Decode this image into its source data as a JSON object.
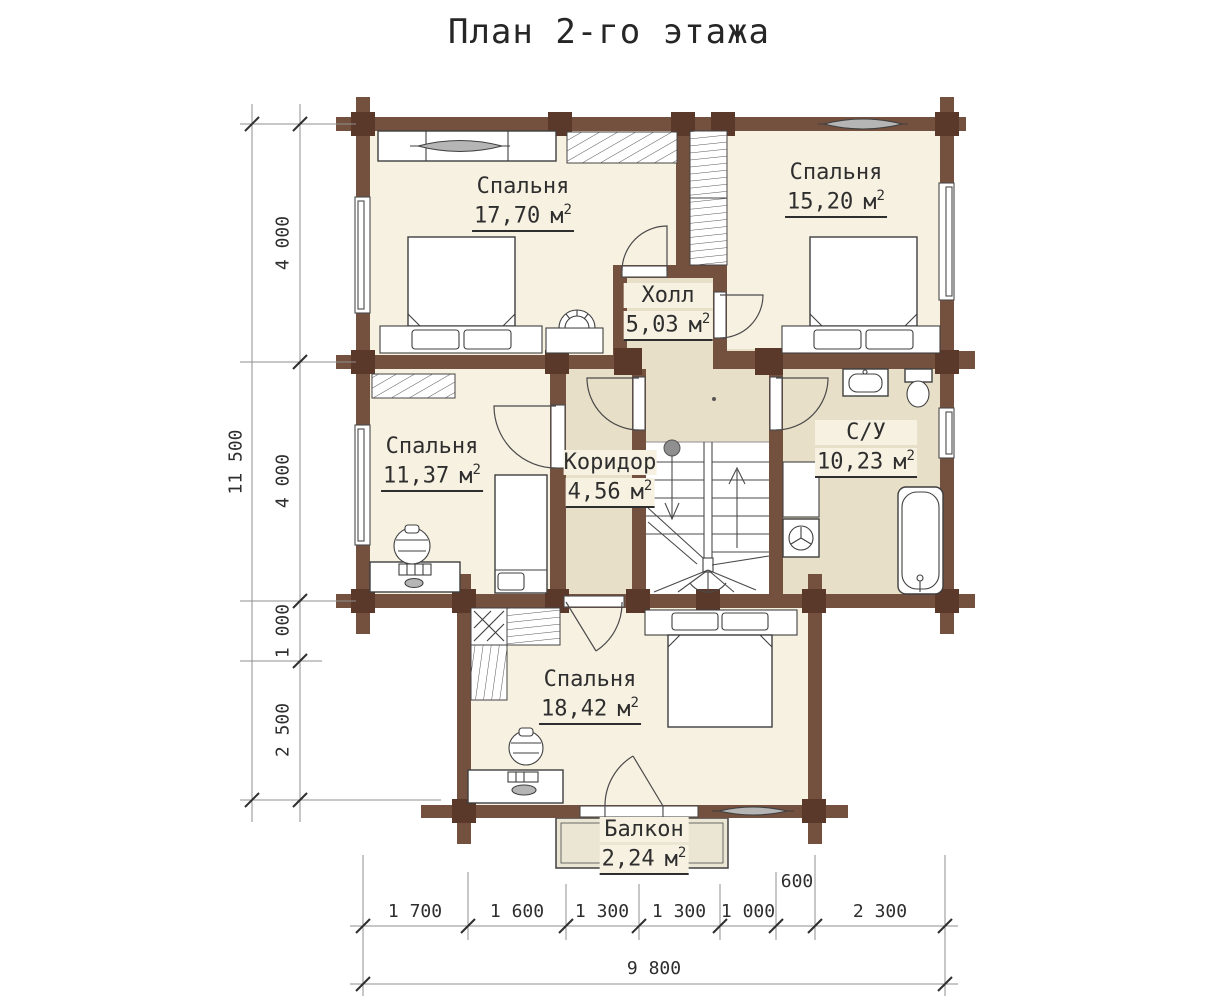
{
  "title": "План 2-го этажа",
  "rooms": [
    {
      "name": "Спальня",
      "area": "17,70",
      "unit": "м",
      "sup": "2"
    },
    {
      "name": "Спальня",
      "area": "15,20",
      "unit": "м",
      "sup": "2"
    },
    {
      "name": "Холл",
      "area": "5,03",
      "unit": "м",
      "sup": "2"
    },
    {
      "name": "Спальня",
      "area": "11,37",
      "unit": "м",
      "sup": "2"
    },
    {
      "name": "Коридор",
      "area": "4,56",
      "unit": "м",
      "sup": "2"
    },
    {
      "name": "С/У",
      "area": "10,23",
      "unit": "м",
      "sup": "2"
    },
    {
      "name": "Спальня",
      "area": "18,42",
      "unit": "м",
      "sup": "2"
    },
    {
      "name": "Балкон",
      "area": "2,24",
      "unit": "м",
      "sup": "2"
    }
  ],
  "dimensions": {
    "left_total": "11 500",
    "left_segments": [
      "4 000",
      "4 000",
      "1 000",
      "2 500"
    ],
    "bottom_segments": [
      "1 700",
      "1 600",
      "1 300",
      "1 300",
      "1 000",
      "600",
      "2 300"
    ],
    "bottom_total": "9 800"
  },
  "colors": {
    "wall": "#74503f",
    "post": "#5a392a",
    "room": "#f7f1e1",
    "svc": "#e8dfc8",
    "balc": "#eae6d3"
  }
}
